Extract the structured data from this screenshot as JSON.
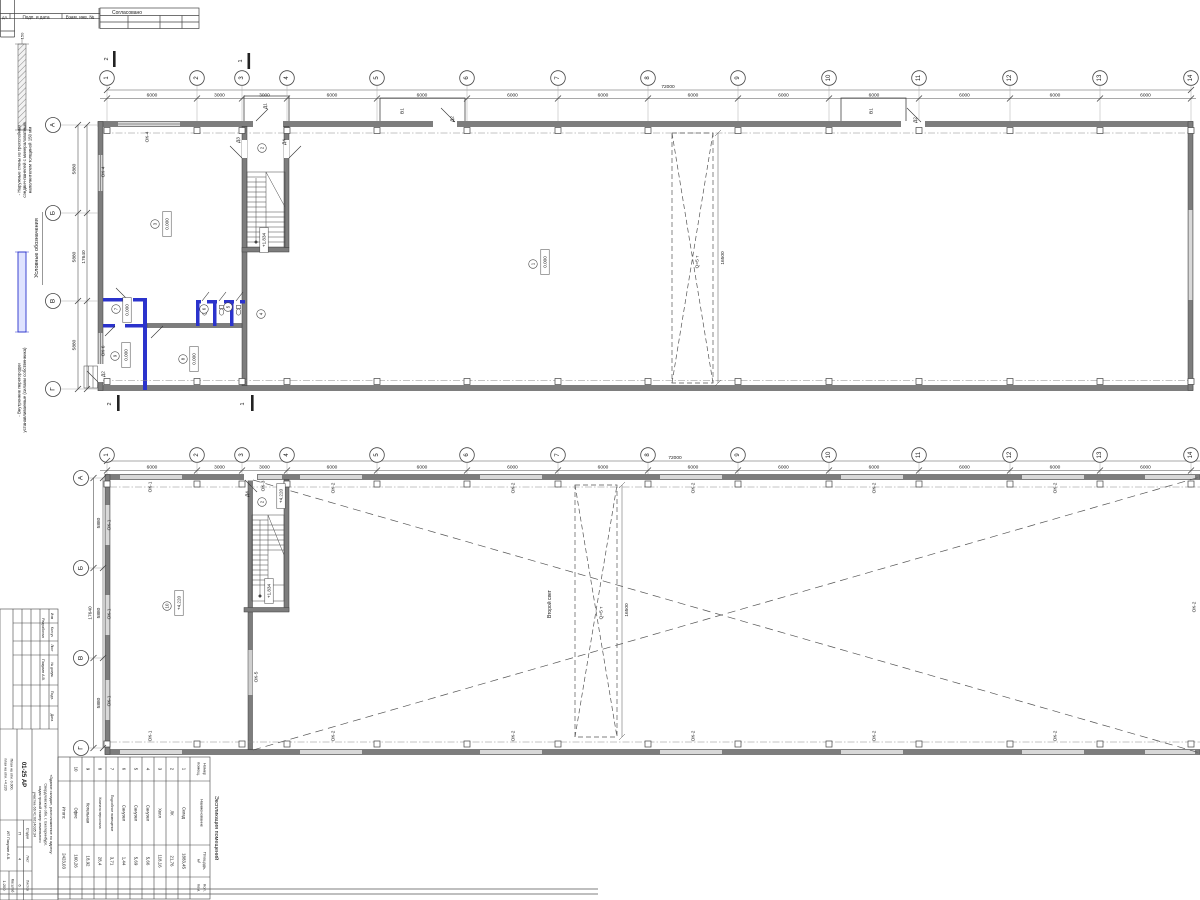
{
  "frame": {
    "cells": [
      "дл.",
      "Подп. и дата",
      "Взам. инв. №"
    ],
    "approved": "Согласовано"
  },
  "legend": {
    "title": "Условные обозначения",
    "wall_thickness": "150",
    "item1_lines": [
      "- Наружные стены из трехслойных",
      "сэндвич-панелей с минераловатным",
      "наполнителем толщиной 150 мм"
    ],
    "item2_lines": [
      "- Внутренние перегородки",
      "устанавливаемые (силами собственника)"
    ],
    "partition_color": "#2b33cc"
  },
  "drawing": {
    "axis_x": [
      107,
      197,
      242,
      287,
      377,
      467,
      558,
      648,
      738,
      829,
      919,
      1010,
      1100,
      1191
    ],
    "axis_labels": [
      "1",
      "2",
      "3",
      "4",
      "5",
      "6",
      "7",
      "8",
      "9",
      "10",
      "11",
      "12",
      "13",
      "14"
    ],
    "row_labels": [
      "А",
      "Б",
      "В",
      "Г"
    ],
    "plan1": {
      "axis_circle_y": 78,
      "row_circle_x": 53,
      "row_y": [
        125,
        213,
        301,
        389
      ]
    },
    "plan2": {
      "axis_circle_y": 455,
      "row_circle_x": 81,
      "row_y": [
        478,
        568,
        658,
        748
      ]
    },
    "room_circles": [
      [
        533,
        264,
        "1"
      ],
      [
        262,
        148,
        "2"
      ],
      [
        155,
        224,
        "3"
      ],
      [
        261,
        314,
        "4"
      ],
      [
        228,
        307,
        "5"
      ],
      [
        204,
        309,
        "6"
      ],
      [
        116,
        309,
        "7"
      ],
      [
        183,
        359,
        "8"
      ],
      [
        115,
        356,
        "9"
      ],
      [
        262,
        502,
        "2"
      ],
      [
        167,
        606,
        "10"
      ]
    ],
    "level_boxes": [
      [
        545,
        262,
        "0.000"
      ],
      [
        167,
        224,
        "0.000"
      ],
      [
        127,
        310,
        "0.000"
      ],
      [
        194,
        359,
        "0.000"
      ],
      [
        126,
        355,
        "0.000"
      ],
      [
        264,
        240,
        "+1.834"
      ],
      [
        281,
        496,
        "+4.220"
      ],
      [
        269,
        591,
        "+1.834"
      ],
      [
        179,
        603,
        "+4.220"
      ]
    ],
    "texts": [
      [
        5,
        16.8,
        "дл.",
        0,
        4
      ],
      [
        36,
        16.8,
        "Подп. и дата",
        0,
        4.6
      ],
      [
        80,
        16.8,
        "Взам. инв. №",
        0,
        4.6
      ],
      [
        127,
        12.8,
        "Согласовано",
        0,
        5
      ],
      [
        37,
        248,
        "Условные обозначения",
        -90,
        5.5
      ],
      [
        19,
        160,
        "- Наружные стены из трехслойных",
        -90,
        4.4
      ],
      [
        24.5,
        160,
        "сэндвич-панелей с минераловатным",
        -90,
        4.4
      ],
      [
        30,
        160,
        "наполнителем толщиной 150 мм",
        -90,
        4.4
      ],
      [
        22,
        36,
        "150",
        -90,
        4
      ],
      [
        19,
        390,
        "- Внутренние перегородки",
        -90,
        4.4
      ],
      [
        24.5,
        390,
        "устанавливаемые (силами собственника)",
        -90,
        4.4
      ],
      [
        152,
        95.8,
        "6000",
        0,
        4.8
      ],
      [
        219.5,
        95.8,
        "3000",
        0,
        4.8
      ],
      [
        264.5,
        95.8,
        "3000",
        0,
        4.8
      ],
      [
        332,
        95.8,
        "6000",
        0,
        4.8
      ],
      [
        422,
        95.8,
        "6000",
        0,
        4.8
      ],
      [
        512.5,
        95.8,
        "6000",
        0,
        4.8
      ],
      [
        603,
        95.8,
        "6000",
        0,
        4.8
      ],
      [
        693,
        95.8,
        "6000",
        0,
        4.8
      ],
      [
        783.5,
        95.8,
        "6000",
        0,
        4.8
      ],
      [
        874,
        95.8,
        "6000",
        0,
        4.8
      ],
      [
        964.5,
        95.8,
        "6000",
        0,
        4.8
      ],
      [
        1055,
        95.8,
        "6000",
        0,
        4.8
      ],
      [
        1145.5,
        95.8,
        "6000",
        0,
        4.8
      ],
      [
        668,
        87.5,
        "72000",
        0,
        4.8
      ],
      [
        75,
        169,
        "5880",
        -90,
        4.8
      ],
      [
        75,
        257,
        "5880",
        -90,
        4.8
      ],
      [
        75,
        345,
        "5880",
        -90,
        4.8
      ],
      [
        84.5,
        257,
        "17640",
        -90,
        4.8
      ],
      [
        152,
        467.8,
        "6000",
        0,
        4.8
      ],
      [
        219.5,
        467.8,
        "3000",
        0,
        4.8
      ],
      [
        264.5,
        467.8,
        "3000",
        0,
        4.8
      ],
      [
        332,
        467.8,
        "6000",
        0,
        4.8
      ],
      [
        422,
        467.8,
        "6000",
        0,
        4.8
      ],
      [
        512.5,
        467.8,
        "6000",
        0,
        4.8
      ],
      [
        603,
        467.8,
        "6000",
        0,
        4.8
      ],
      [
        693,
        467.8,
        "6000",
        0,
        4.8
      ],
      [
        783.5,
        467.8,
        "6000",
        0,
        4.8
      ],
      [
        874,
        467.8,
        "6000",
        0,
        4.8
      ],
      [
        964.5,
        467.8,
        "6000",
        0,
        4.8
      ],
      [
        1055,
        467.8,
        "6000",
        0,
        4.8
      ],
      [
        1145.5,
        467.8,
        "6000",
        0,
        4.8
      ],
      [
        675,
        458.5,
        "72000",
        0,
        4.8
      ],
      [
        99.5,
        523,
        "5880",
        -90,
        4.8
      ],
      [
        99.5,
        613,
        "5880",
        -90,
        4.8
      ],
      [
        99.5,
        703,
        "5880",
        -90,
        4.8
      ],
      [
        91,
        613,
        "17640",
        -90,
        4.8
      ],
      [
        148,
        137,
        "ОК-4",
        -90,
        4.8
      ],
      [
        104,
        172,
        "ОК-4",
        -90,
        4.8
      ],
      [
        104,
        351,
        "ОК-6",
        -90,
        4.8
      ],
      [
        104,
        374,
        "Д2",
        -90,
        4.8
      ],
      [
        266,
        106,
        "Д1",
        -90,
        4.8
      ],
      [
        239,
        140,
        "Д3",
        -90,
        4.8
      ],
      [
        285,
        142,
        "Д4",
        -90,
        4.8
      ],
      [
        403,
        111,
        "В1",
        -90,
        4.8
      ],
      [
        453,
        119,
        "Д2",
        -90,
        4.8
      ],
      [
        872,
        111,
        "В1",
        -90,
        4.8
      ],
      [
        916,
        120,
        "Д2",
        -90,
        4.8
      ],
      [
        698,
        262,
        "Q=5 т",
        -90,
        4.8
      ],
      [
        723.5,
        258,
        "16500",
        -90,
        4.8
      ],
      [
        107,
        59,
        "2",
        -90,
        5.5
      ],
      [
        241,
        61,
        "1",
        -90,
        5.5
      ],
      [
        110,
        404,
        "2",
        -90,
        5.5
      ],
      [
        243,
        404,
        "1",
        -90,
        5.5
      ],
      [
        151,
        487,
        "ОК-1",
        -90,
        4.8
      ],
      [
        264,
        486,
        "ОК-3",
        -90,
        4.8
      ],
      [
        248,
        494,
        "Д4",
        -90,
        4.8
      ],
      [
        334,
        488,
        "ОК-2",
        -90,
        4.8
      ],
      [
        514,
        488,
        "ОК-2",
        -90,
        4.8
      ],
      [
        694,
        488,
        "ОК-2",
        -90,
        4.8
      ],
      [
        875,
        488,
        "ОК-2",
        -90,
        4.8
      ],
      [
        1056,
        488,
        "ОК-2",
        -90,
        4.8
      ],
      [
        1195,
        607,
        "ОК-2",
        -90,
        4.8
      ],
      [
        110,
        525,
        "ОК-1",
        -90,
        4.8
      ],
      [
        110,
        614,
        "ОК-1",
        -90,
        4.8
      ],
      [
        110,
        701,
        "ОК-1",
        -90,
        4.8
      ],
      [
        257,
        677,
        "ОК-5",
        -90,
        4.8
      ],
      [
        151,
        736,
        "ОК-1",
        -90,
        4.8
      ],
      [
        334,
        736,
        "ОК-2",
        -90,
        4.8
      ],
      [
        514,
        736,
        "ОК-2",
        -90,
        4.8
      ],
      [
        694,
        736,
        "ОК-2",
        -90,
        4.8
      ],
      [
        875,
        736,
        "ОК-2",
        -90,
        4.8
      ],
      [
        1056,
        736,
        "ОК-2",
        -90,
        4.8
      ],
      [
        550,
        604,
        "Второй свет",
        -90,
        5
      ],
      [
        602,
        613,
        "Q=5 т",
        -90,
        4.8
      ],
      [
        627.5,
        610,
        "16500",
        -90,
        4.8
      ]
    ],
    "stamp_texts": [
      [
        7,
        6,
        "Изм",
        3.4
      ],
      [
        23,
        6,
        "Кол.уч",
        3.4
      ],
      [
        39,
        6,
        "Лист",
        3.4
      ],
      [
        61,
        6,
        "№ докум.",
        3.4
      ],
      [
        86.5,
        6,
        "Подп.",
        3.4
      ],
      [
        108.5,
        6,
        "Дата",
        3.4
      ],
      [
        19,
        15,
        "Разработал",
        3.6
      ],
      [
        61,
        15,
        "Пакулин А.В.",
        3.6
      ],
      [
        205.5,
        7,
        "«Здание склада», расположенное по адресу:",
        3.8
      ],
      [
        205.5,
        12.5,
        "Свердловская обл, г. Екатеринбург,",
        3.8
      ],
      [
        205.5,
        18,
        "кадастровый номер земельного",
        3.8
      ],
      [
        205.5,
        23.5,
        "участка 66:41:0614035:34",
        3.8
      ],
      [
        165.5,
        35,
        "01-25 АР",
        6,
        1
      ],
      [
        224.5,
        30.5,
        "Стадия",
        3.3
      ],
      [
        250,
        30.5,
        "Лист",
        3.3
      ],
      [
        276.5,
        30.5,
        "Листов",
        3.3
      ],
      [
        224.5,
        38,
        "П",
        4
      ],
      [
        250,
        38,
        "4",
        4
      ],
      [
        276.5,
        38,
        "6",
        4
      ],
      [
        165.5,
        46.5,
        "План на отм. 0.000,",
        3.5
      ],
      [
        165.5,
        52.5,
        "план на отм. +4.220",
        3.5
      ],
      [
        236.5,
        50,
        "ИП Пакулин А.В.",
        3.8
      ],
      [
        276.5,
        45.5,
        "Масштаб",
        3.2
      ],
      [
        276.5,
        53.5,
        "1:200",
        4
      ]
    ]
  },
  "schedule": {
    "title": "Экспликация помещений",
    "col_headers": [
      [
        "Номер",
        "помещ."
      ],
      [
        "Наименование"
      ],
      [
        "Площадь,",
        "м²"
      ],
      [
        "Кол.",
        "пом."
      ]
    ],
    "rows": [
      [
        "1",
        "Склад",
        "1883,45"
      ],
      [
        "2",
        "ЛК",
        "21,76"
      ],
      [
        "3",
        "Холл",
        "118,16"
      ],
      [
        "4",
        "Санузел",
        "5,66"
      ],
      [
        "5",
        "Санузел",
        "5,69"
      ],
      [
        "6",
        "Санузел",
        "1,44"
      ],
      [
        "7",
        "Подсобное помещение",
        "3,71"
      ],
      [
        "8",
        "Комната персонала",
        "28,4"
      ],
      [
        "9",
        "Котельная",
        "18,92"
      ],
      [
        "10",
        "Офис",
        "160,26"
      ]
    ],
    "total_label": "Итого:",
    "total_value": "2423,03"
  }
}
